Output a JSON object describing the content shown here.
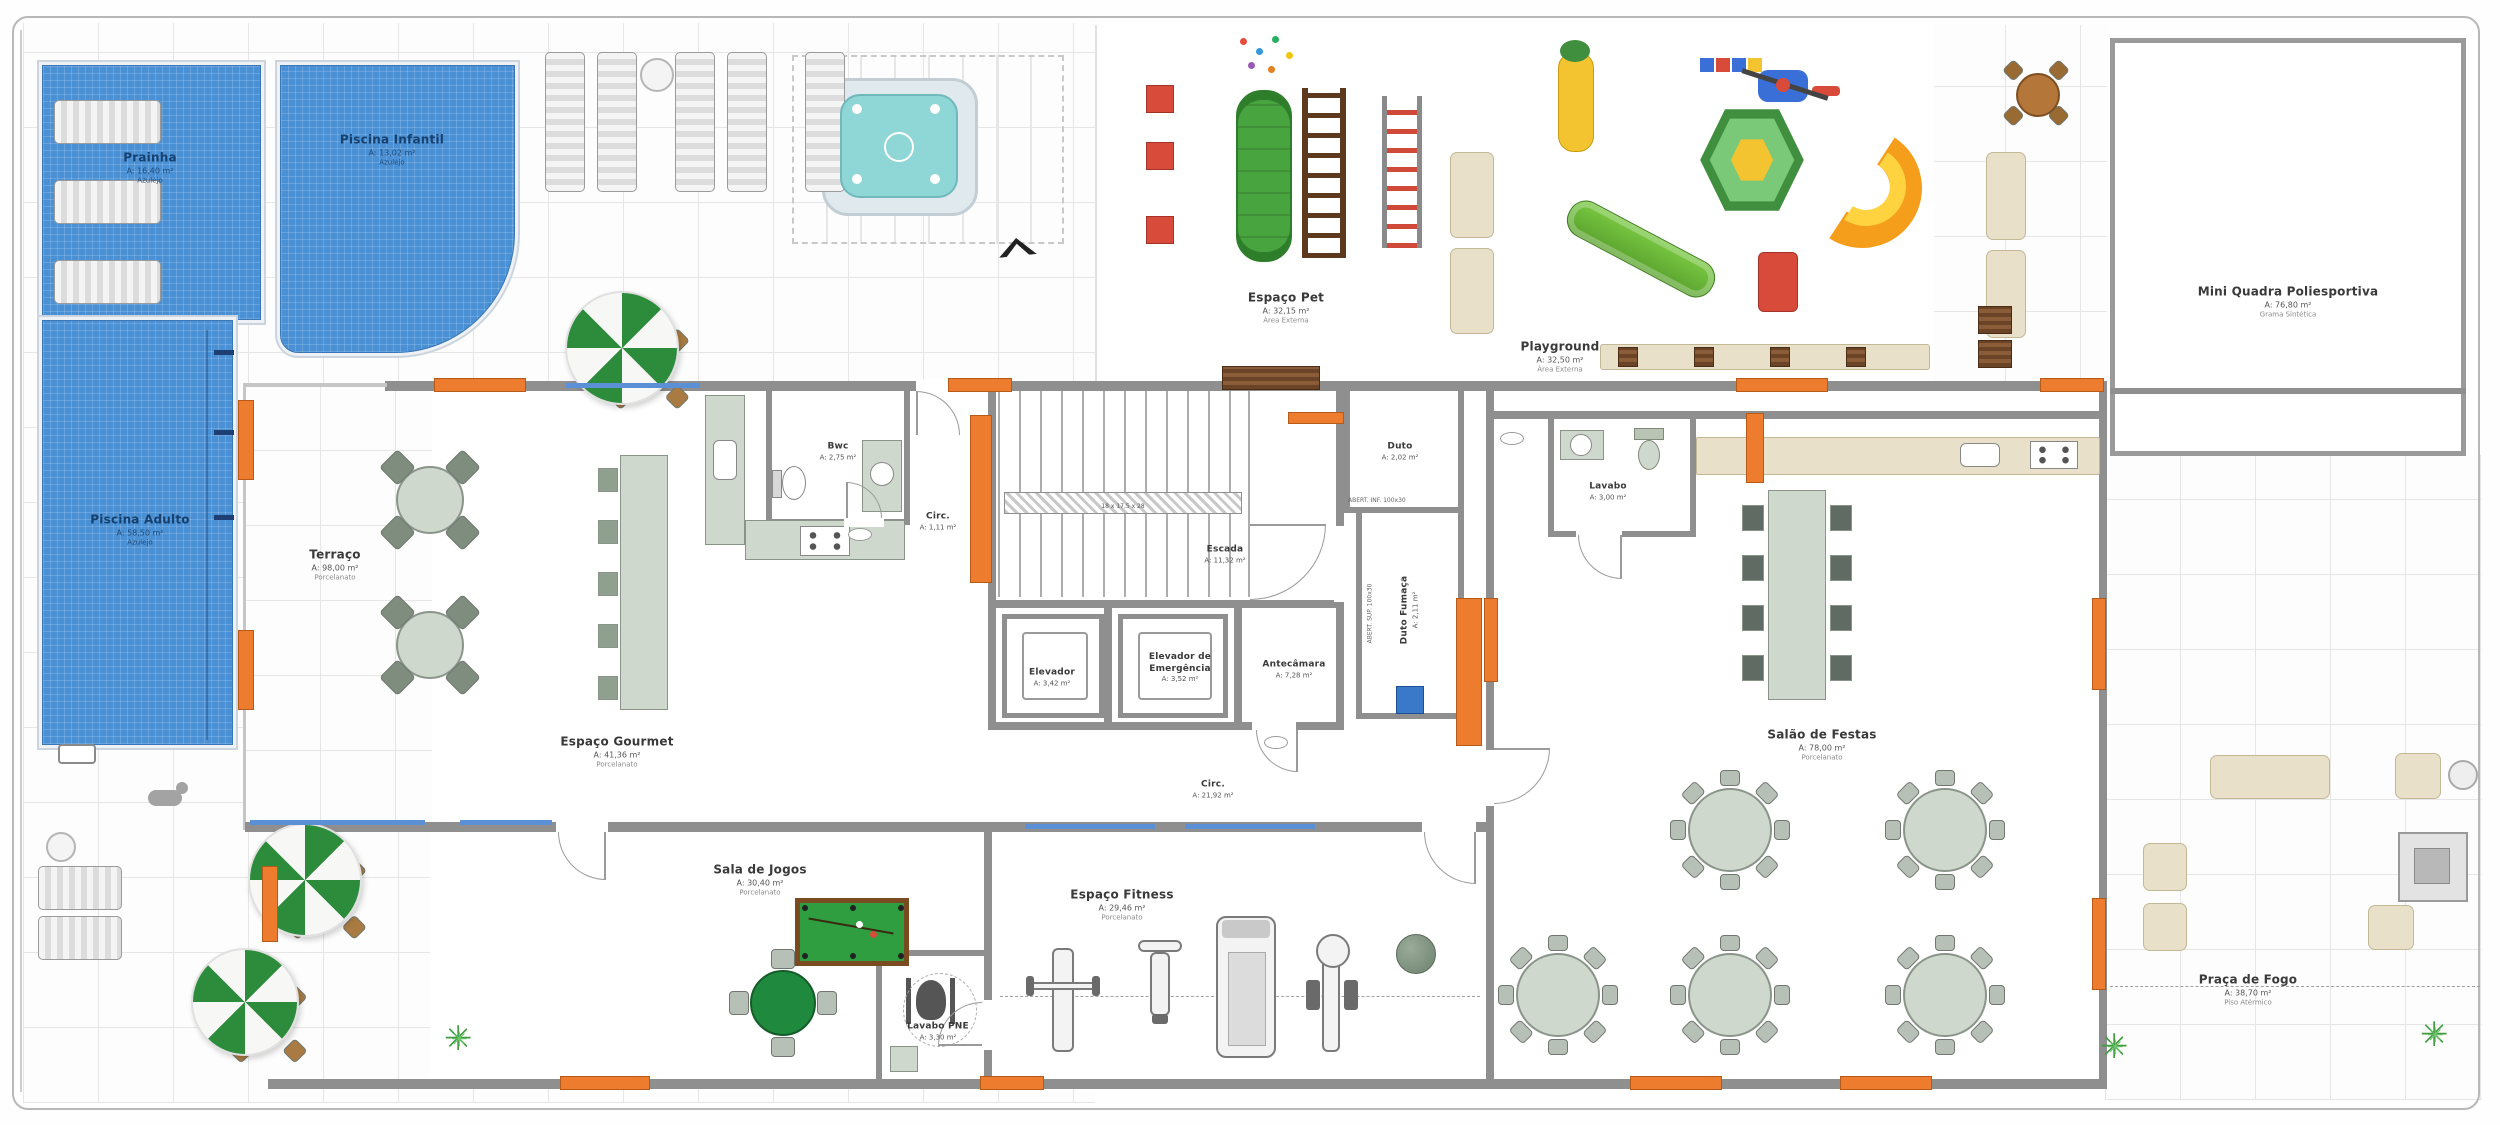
{
  "rooms": {
    "prainha": {
      "name": "Prainha",
      "area": "A: 16,40 m²",
      "extra": "Azulejo"
    },
    "piscina_infantil": {
      "name": "Piscina Infantil",
      "area": "A: 13,02 m²",
      "extra": "Azulejo"
    },
    "piscina_adulto": {
      "name": "Piscina Adulto",
      "area": "A: 58,50 m²",
      "extra": "Azulejo"
    },
    "terraco": {
      "name": "Terraço",
      "area": "A: 98,00 m²",
      "extra": "Porcelanato"
    },
    "espaco_gourmet": {
      "name": "Espaço Gourmet",
      "area": "A: 41,36 m²",
      "extra": "Porcelanato"
    },
    "bwc": {
      "name": "Bwc",
      "area": "A: 2,75 m²"
    },
    "circ1": {
      "name": "Circ.",
      "area": "A: 1,11 m²"
    },
    "escada": {
      "name": "Escada",
      "area": "A: 11,32 m²"
    },
    "elevador": {
      "name": "Elevador",
      "area": "A: 3,42 m²"
    },
    "elevador_emergencia": {
      "name": "Elevador de Emergência",
      "area": "A: 3,52 m²"
    },
    "antecamara": {
      "name": "Antecâmara",
      "area": "A: 7,28 m²"
    },
    "duto": {
      "name": "Duto",
      "area": "A: 2,02 m²"
    },
    "duto_fumaca": {
      "name": "Duto Fumaça",
      "area": "A: 2,11 m²"
    },
    "lavabo": {
      "name": "Lavabo",
      "area": "A: 3,00 m²",
      "extra": "Porcelanato"
    },
    "espaco_pet": {
      "name": "Espaço Pet",
      "area": "A: 32,15 m²",
      "extra": "Área Externa"
    },
    "playground": {
      "name": "Playground",
      "area": "A: 32,50 m²",
      "extra": "Área Externa"
    },
    "mini_quadra": {
      "name": "Mini Quadra Poliesportiva",
      "area": "A: 76,80 m²",
      "extra": "Grama Sintética"
    },
    "salao_festas": {
      "name": "Salão de Festas",
      "area": "A: 78,00 m²",
      "extra": "Porcelanato"
    },
    "sala_jogos": {
      "name": "Sala de Jogos",
      "area": "A: 30,40 m²",
      "extra": "Porcelanato"
    },
    "espaco_fitness": {
      "name": "Espaço Fitness",
      "area": "A: 29,46 m²",
      "extra": "Porcelanato"
    },
    "circ2": {
      "name": "Circ.",
      "area": "A: 21,92 m²",
      "extra": "Porcelanato"
    },
    "lavabo_pne": {
      "name": "Lavabo PNE",
      "area": "A: 3,30 m²",
      "extra": "Porcelanato"
    },
    "praca_fogo": {
      "name": "Praça de Fogo",
      "area": "A: 38,70 m²",
      "extra": "Piso Atérmico"
    }
  },
  "annotations": {
    "duto_spec": "ABERT. INF. 100x30",
    "duto_fumaca_spec": "ABERT. SUP. 100x30",
    "stair_spec": "18 x 17,5 x 28"
  },
  "icons": {
    "plant_glyph": "✳"
  },
  "colors": {
    "pool_blue": "#4a90d5",
    "wall_gray": "#8f8f8f",
    "column_orange": "#ee7c2e",
    "glass_blue": "#5b8fd6",
    "felt_green": "#2f9e41",
    "sage": "#cfd8cc",
    "beige": "#e8e0c9"
  }
}
